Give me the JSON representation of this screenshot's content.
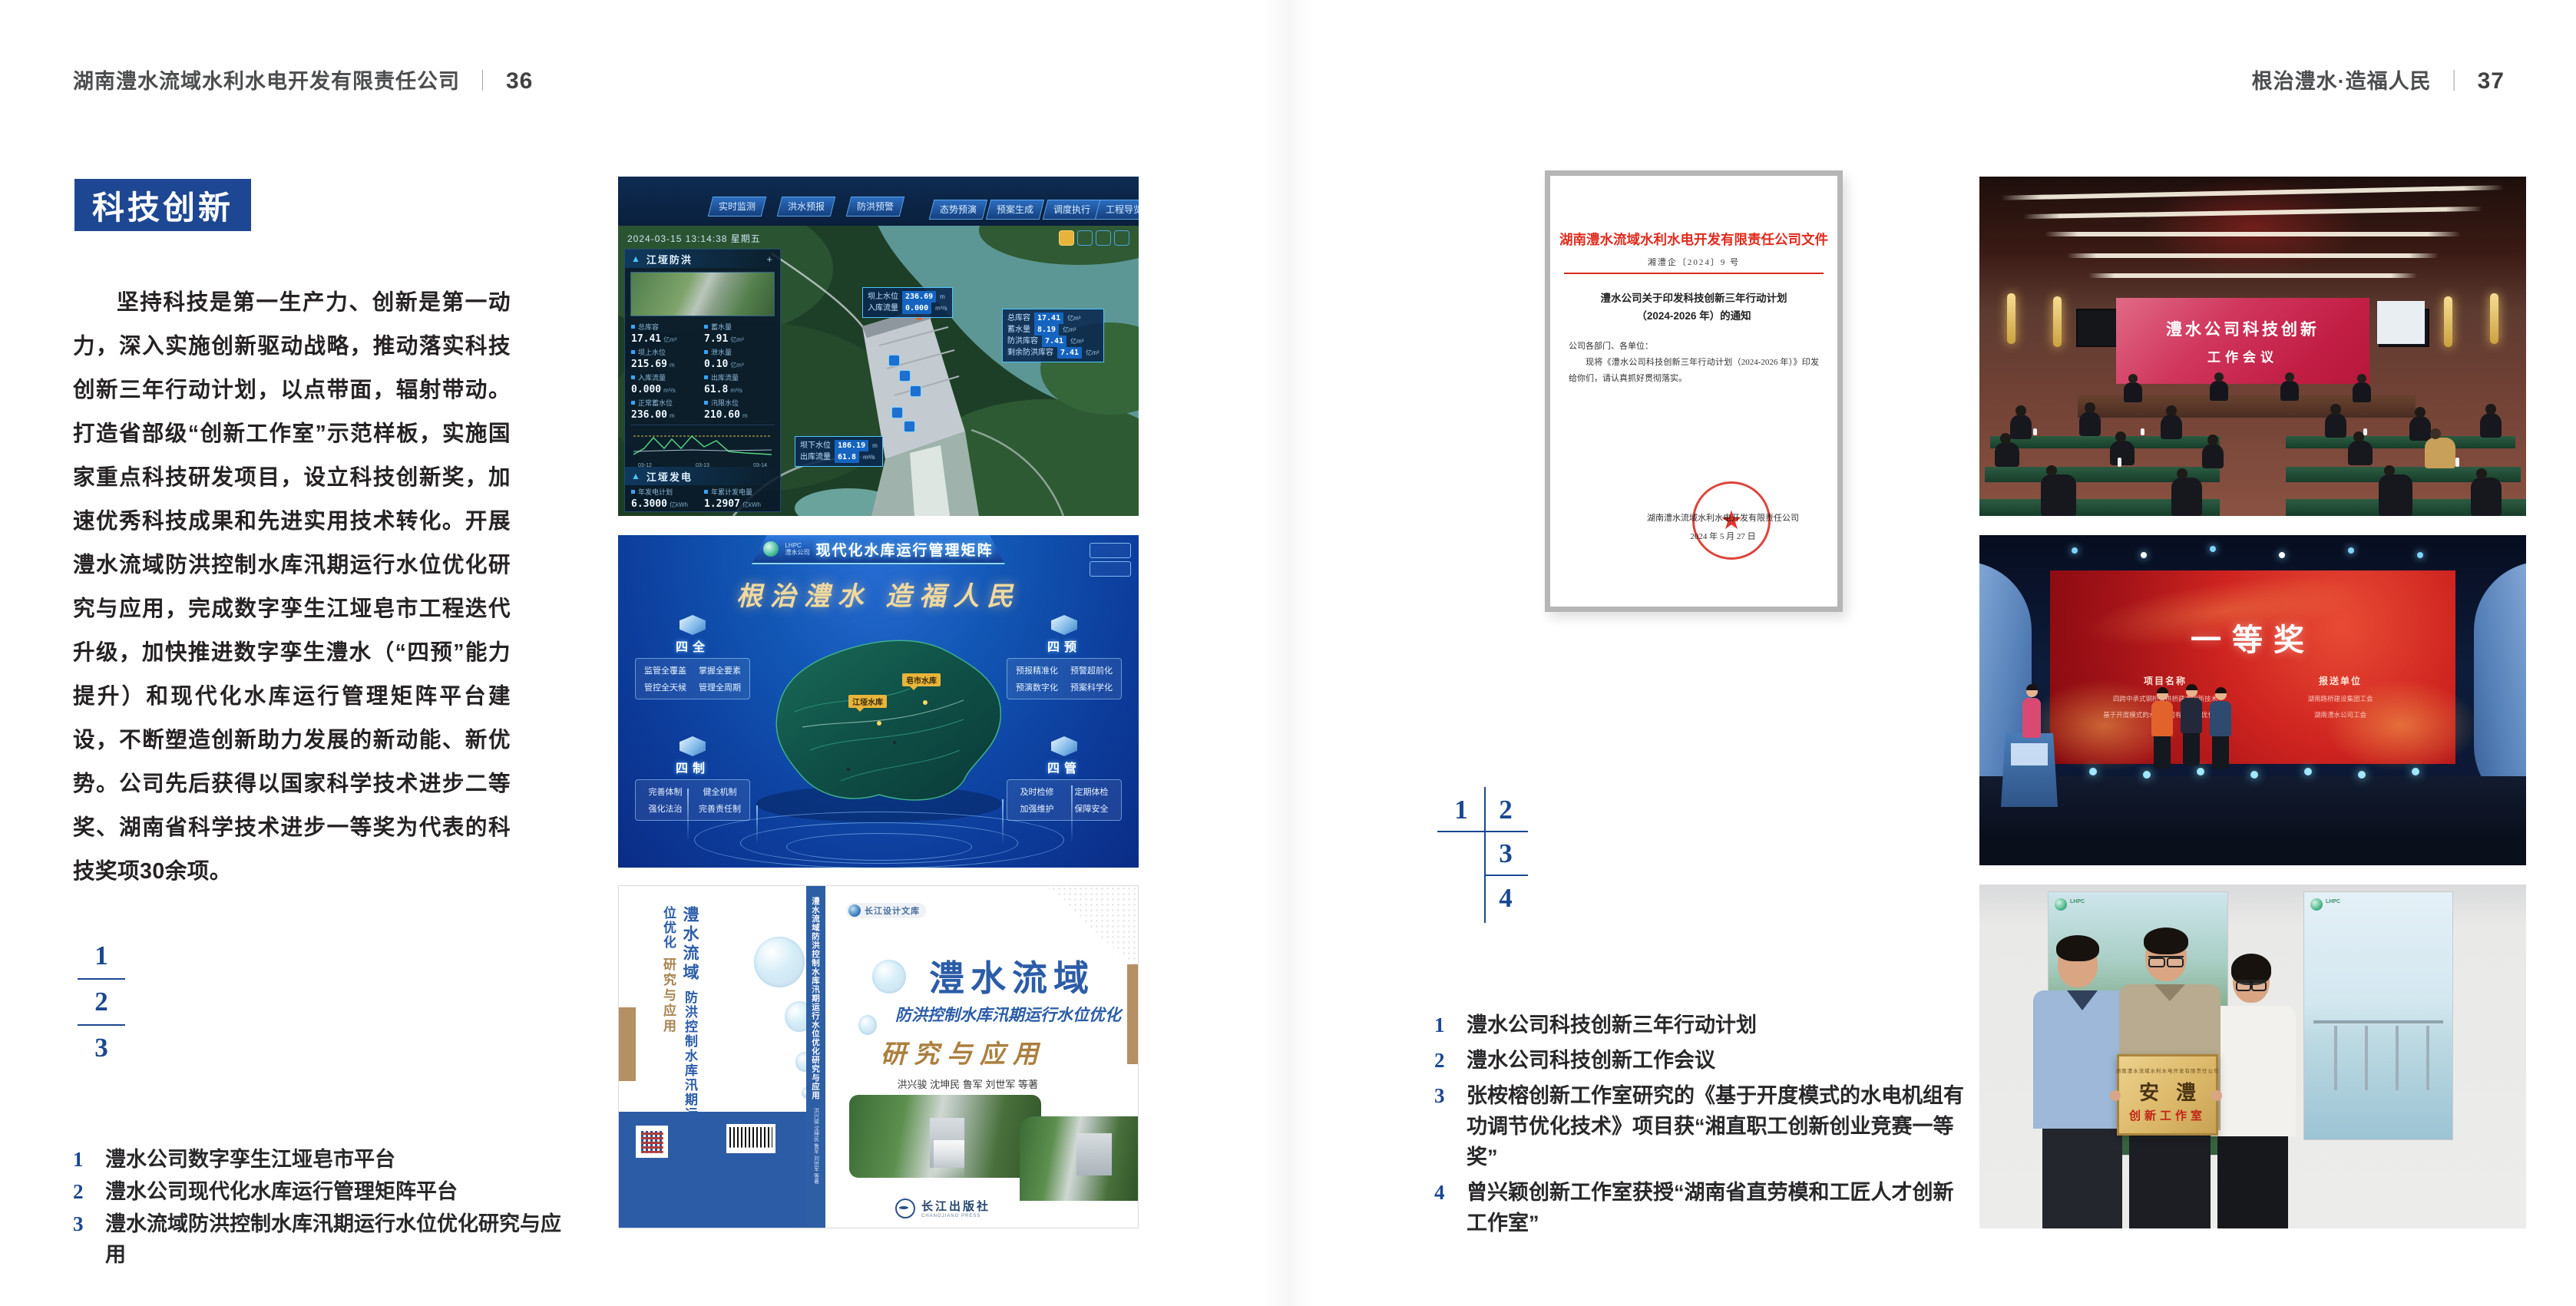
{
  "colors": {
    "accent_blue": "#1d4792",
    "index_blue": "#1b4791",
    "doc_red": "#d92a1c",
    "gold_tag": "#e8b53a",
    "book_blue": "#2b5ca8",
    "book_tan": "#b49063"
  },
  "left_page": {
    "header": {
      "title": "湖南澧水流域水利水电开发有限责任公司",
      "separator": "｜",
      "page": "36"
    },
    "section_title": "科技创新",
    "body": "坚持科技是第一生产力、创新是第一动力，深入实施创新驱动战略，推动落实科技创新三年行动计划，以点带面，辐射带动。打造省部级“创新工作室”示范样板，实施国家重点科技研发项目，设立科技创新奖，加速优秀科技成果和先进实用技术转化。开展澧水流域防洪控制水库汛期运行水位优化研究与应用，完成数字孪生江垭皂市工程迭代升级，加快推进数字孪生澧水（“四预”能力提升）和现代化水库运行管理矩阵平台建设，不断塑造创新助力发展的新动能、新优势。公司先后获得以国家科学技术进步二等奖、湖南省科学技术进步一等奖为代表的科技奖项30余项。",
    "index_numbers": [
      "1",
      "2",
      "3"
    ],
    "captions": [
      {
        "n": "1",
        "t": "澧水公司数字孪生江垭皂市平台"
      },
      {
        "n": "2",
        "t": "澧水公司现代化水库运行管理矩阵平台"
      },
      {
        "n": "3",
        "t": "澧水流域防洪控制水库汛期运行水位优化研究与应用"
      }
    ]
  },
  "right_page": {
    "header": {
      "title": "根治澧水·造福人民",
      "separator": "｜",
      "page": "37"
    },
    "index_numbers": [
      "1",
      "2",
      "3",
      "4"
    ],
    "captions": [
      {
        "n": "1",
        "t": "澧水公司科技创新三年行动计划"
      },
      {
        "n": "2",
        "t": "澧水公司科技创新工作会议"
      },
      {
        "n": "3",
        "t": "张桉榕创新工作室研究的《基于开度模式的水电机组有功调节优化技术》项目获“湘直职工创新创业竞赛一等奖”"
      },
      {
        "n": "4",
        "t": "曾兴颖创新工作室获授“湖南省直劳模和工匠人才创新工作室”"
      }
    ]
  },
  "dashboard": {
    "title": "数字孪生江垭皂市",
    "mode_label": "防汛兴利调度",
    "tabs_left": [
      "实时监测",
      "洪水预报",
      "防洪预警"
    ],
    "tabs_right": [
      "态势预演",
      "预案生成",
      "调度执行",
      "工程导览"
    ],
    "datetime": "2024-03-15 13:14:38 星期五",
    "panel1_title": "江垭防洪",
    "panel1_stats": [
      {
        "l": "总库容",
        "v": "17.41",
        "u": "亿m³"
      },
      {
        "l": "蓄水量",
        "v": "7.91",
        "u": "亿m³"
      },
      {
        "l": "坝上水位",
        "v": "215.69",
        "u": "m"
      },
      {
        "l": "泄水量",
        "v": "0.10",
        "u": "亿m³"
      },
      {
        "l": "入库流量",
        "v": "0.000",
        "u": "m³/s"
      },
      {
        "l": "出库流量",
        "v": "61.8",
        "u": "m³/s"
      },
      {
        "l": "正常蓄水位",
        "v": "236.00",
        "u": "m"
      },
      {
        "l": "汛限水位",
        "v": "210.60",
        "u": "m"
      }
    ],
    "chart_x": [
      "03-12",
      "03-13",
      "03-14"
    ],
    "panel2_title": "江垭发电",
    "panel2_stats": [
      {
        "l": "年发电计划",
        "v": "6.3000",
        "u": "亿kWh"
      },
      {
        "l": "年累计发电量",
        "v": "1.2907",
        "u": "亿kWh"
      },
      {
        "l": "月累计发电量",
        "v": "3359.21",
        "u": "万kWh"
      },
      {
        "l": "当前出力",
        "v": "0.00",
        "u": "MW"
      }
    ],
    "gauges": [
      "0.00",
      "102.98",
      "0.00"
    ],
    "tip1": [
      {
        "l": "坝上水位",
        "v": "236.69",
        "u": "m"
      },
      {
        "l": "入库流量",
        "v": "0.000",
        "u": "m³/s"
      }
    ],
    "tip2": [
      {
        "l": "总库容",
        "v": "17.41",
        "u": "亿m³"
      },
      {
        "l": "蓄水量",
        "v": "8.19",
        "u": "亿m³"
      },
      {
        "l": "防洪库容",
        "v": "7.41",
        "u": "亿m³"
      },
      {
        "l": "剩余防洪库容",
        "v": "7.41",
        "u": "亿m³"
      }
    ],
    "tip3": [
      {
        "l": "坝下水位",
        "v": "186.19",
        "u": "m"
      },
      {
        "l": "出库流量",
        "v": "61.8",
        "u": "m³/s"
      }
    ]
  },
  "platform": {
    "logo_line1": "LHPC",
    "logo_line2": "澧水公司",
    "title": "现代化水库运行管理矩阵",
    "slogan": "根治澧水 造福人民",
    "panels": [
      {
        "title": "四全",
        "items": [
          "监管全覆盖",
          "掌握全要素",
          "管控全天候",
          "管理全周期"
        ]
      },
      {
        "title": "四制",
        "items": [
          "完善体制",
          "健全机制",
          "强化法治",
          "完善责任制"
        ]
      },
      {
        "title": "四预",
        "items": [
          "预报精准化",
          "预警超前化",
          "预演数字化",
          "预案科学化"
        ]
      },
      {
        "title": "四管",
        "items": [
          "及时检修",
          "定期体检",
          "加强维护",
          "保障安全"
        ]
      }
    ],
    "map_tags": [
      "皂市水库",
      "江垭水库"
    ]
  },
  "book": {
    "series_badge": "长江设计文库",
    "title": "澧水流域",
    "subtitle": "防洪控制水库汛期运行水位优化",
    "subtitle2": "研究与应用",
    "authors": "洪兴骏 沈坤民 鲁军 刘世军 等著",
    "publisher": "长江出版社",
    "publisher_en": "CHANGJIANG PRESS",
    "spine_title": "澧水流域防洪控制水库汛期运行水位优化研究与应用",
    "spine_authors": "洪兴骏 沈坤民 鲁军 刘世军 等著",
    "back_title_lines": [
      "澧水流域",
      "防洪控制水库汛期运行水位优化",
      "研究与应用"
    ]
  },
  "document": {
    "header": "湖南澧水流域水利水电开发有限责任公司文件",
    "doc_number": "湘澧企〔2024〕9 号",
    "title_line1": "澧水公司关于印发科技创新三年行动计划",
    "title_line2": "（2024-2026 年）的通知",
    "salutation": "公司各部门、各单位：",
    "body": "现将《澧水公司科技创新三年行动计划（2024-2026 年）》印发给你们，请认真抓好贯彻落实。",
    "signer": "湖南澧水流域水利水电开发有限责任公司",
    "date": "2024 年 5 月 27 日"
  },
  "meeting": {
    "screen_line1": "澧水公司科技创新",
    "screen_line2": "工作会议"
  },
  "award": {
    "screen_title": "一等奖",
    "col1_header": "项目名称",
    "col1_items": [
      "四跨中承式钢桁架拱桥建造创新技术",
      "基于开度模式的水电机组有功调节优化技术"
    ],
    "col2_header": "报送单位",
    "col2_items": [
      "湖南路桥建设集团工会",
      "湖南澧水公司工会"
    ]
  },
  "plaque": {
    "org_line": "湖南澧水流域水利水电开发有限责任公司",
    "name": "安澧",
    "type": "创新工作室"
  }
}
